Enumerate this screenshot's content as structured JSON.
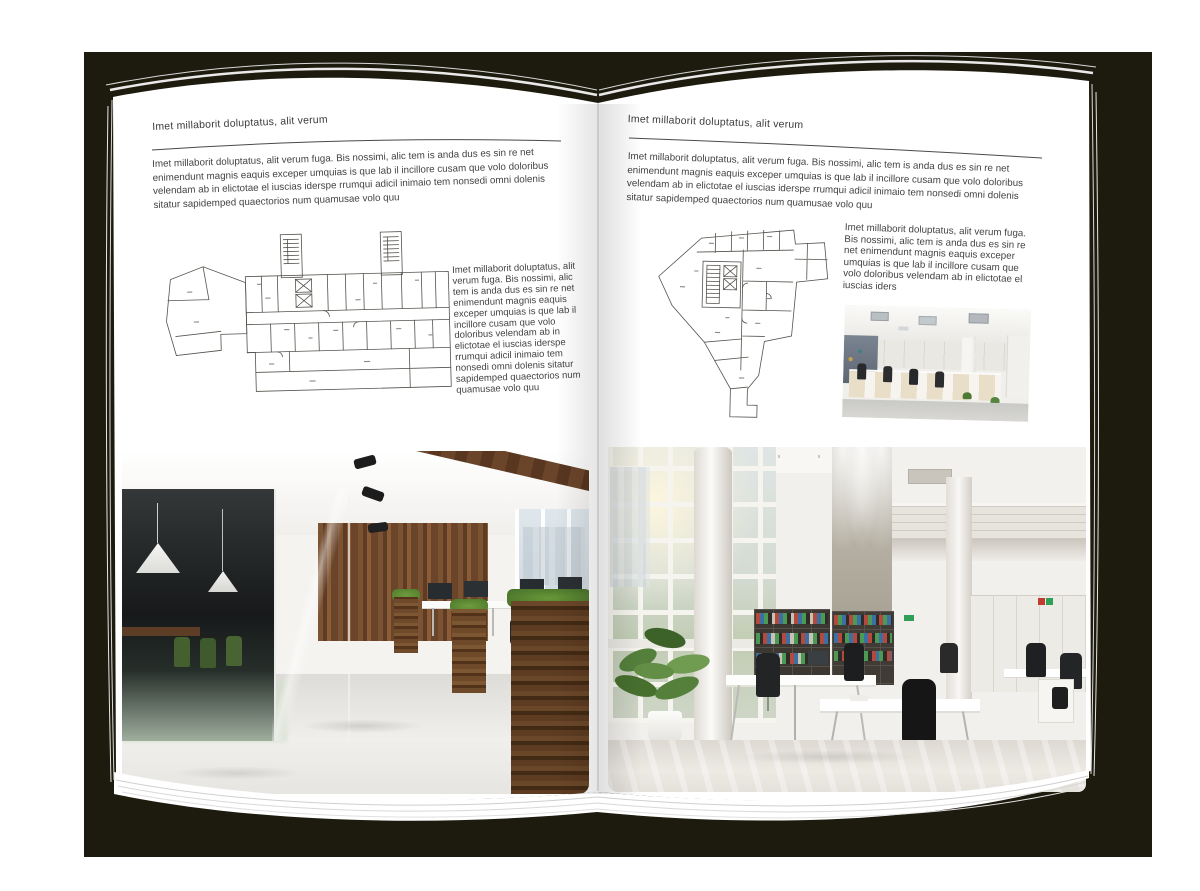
{
  "colors": {
    "backdrop": "#1d1b0d",
    "page": "#ffffff",
    "ink": "#3f3f3f",
    "rule": "#4a4a4a",
    "plan": "#55524c"
  },
  "left_page": {
    "header": "Imet millaborit doluptatus, alit verum",
    "intro": "Imet millaborit doluptatus, alit verum fuga. Bis nossimi, alic tem is anda dus es sin re net enimendunt magnis eaquis exceper umquias is que lab il incillore cusam que volo doloribus velendam ab in elictotae el iuscias iderspe rrumqui adicil inimaio tem nonsedi omni dolenis sitatur sapidemped quaectorios num quamusae volo quu",
    "side_text": "Imet millaborit doluptatus, alit verum fuga. Bis nossimi, alic tem is anda dus es sin re net enimendunt magnis eaquis exceper umquias is que lab il incillore cusam que volo doloribus velendam ab in elictotae el iuscias iderspe rrumqui adicil inimaio tem nonsedi omni dolenis sitatur sapidemped quaectorios num quamusae volo quu"
  },
  "right_page": {
    "header": "Imet millaborit doluptatus, alit verum",
    "intro": "Imet millaborit doluptatus, alit verum fuga. Bis nossimi, alic tem is anda dus es sin re net enimendunt magnis eaquis exceper umquias is que lab il incillore cusam que volo doloribus velendam ab in elictotae el iuscias iderspe rrumqui adicil inimaio tem nonsedi omni dolenis sitatur sapidemped quaectorios num quamusae volo quu",
    "side_text": "Imet millaborit doluptatus, alit verum fuga. Bis nossimi, alic tem is anda dus es sin re net enimendunt magnis eaquis exceper umquias is que lab il incillore cusam que volo doloribus velendam ab in elictotae el iuscias iders"
  },
  "figures": {
    "left_floor_plan": "floor-plan-drawing",
    "right_floor_plan": "floor-plan-drawing",
    "left_photo": "office-interior-photo",
    "right_photo": "office-atrium-photo",
    "small_photo": "open-plan-office-photo"
  }
}
